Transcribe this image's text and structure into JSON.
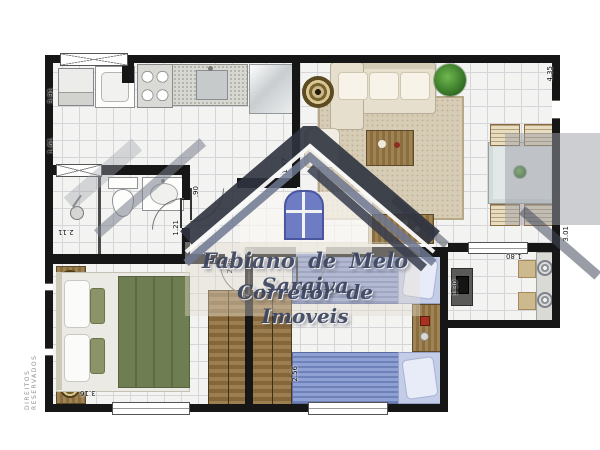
{
  "meta": {
    "type": "apartment-floor-plan"
  },
  "watermark": {
    "line1": "Fabiano de Melo Saraiva",
    "line2": "Corretor de Imoveis",
    "text_color": "#3c455f",
    "logo_roof_color": "#2d333f",
    "logo_window_color": "#6e7cc4"
  },
  "copyright": "DIREITOS RESERVADOS",
  "palette": {
    "wall": "#161616",
    "floor": "#f3f3f1",
    "grid": "#d6d6da",
    "wood": "#96794e",
    "bed_green": "#6f7d52",
    "bed_blue": "#7688bd",
    "sofa": "#e6dfcd",
    "rug": "#d7ccb5"
  },
  "measurements": [
    {
      "id": "left-wall-upper",
      "value": "3.91"
    },
    {
      "id": "left-wall-mid",
      "value": "1.61"
    },
    {
      "id": "bathroom-bottom",
      "value": "2.11"
    },
    {
      "id": "bathroom-right",
      "value": "1.21"
    },
    {
      "id": "hall-door",
      "value": ".90"
    },
    {
      "id": "hall-wall",
      "value": "1.97"
    },
    {
      "id": "bedroom1-top",
      "value": "2.88"
    },
    {
      "id": "bedroom1-door",
      "value": ".80"
    },
    {
      "id": "bedroom1-bottom",
      "value": "3.16"
    },
    {
      "id": "bedroom2-side",
      "value": "2.56"
    },
    {
      "id": "living-right",
      "value": "4.35"
    },
    {
      "id": "terrace-right",
      "value": "3.01"
    },
    {
      "id": "terrace-top",
      "value": "1.80"
    },
    {
      "id": "terrace-left",
      "value": "1.30"
    }
  ]
}
